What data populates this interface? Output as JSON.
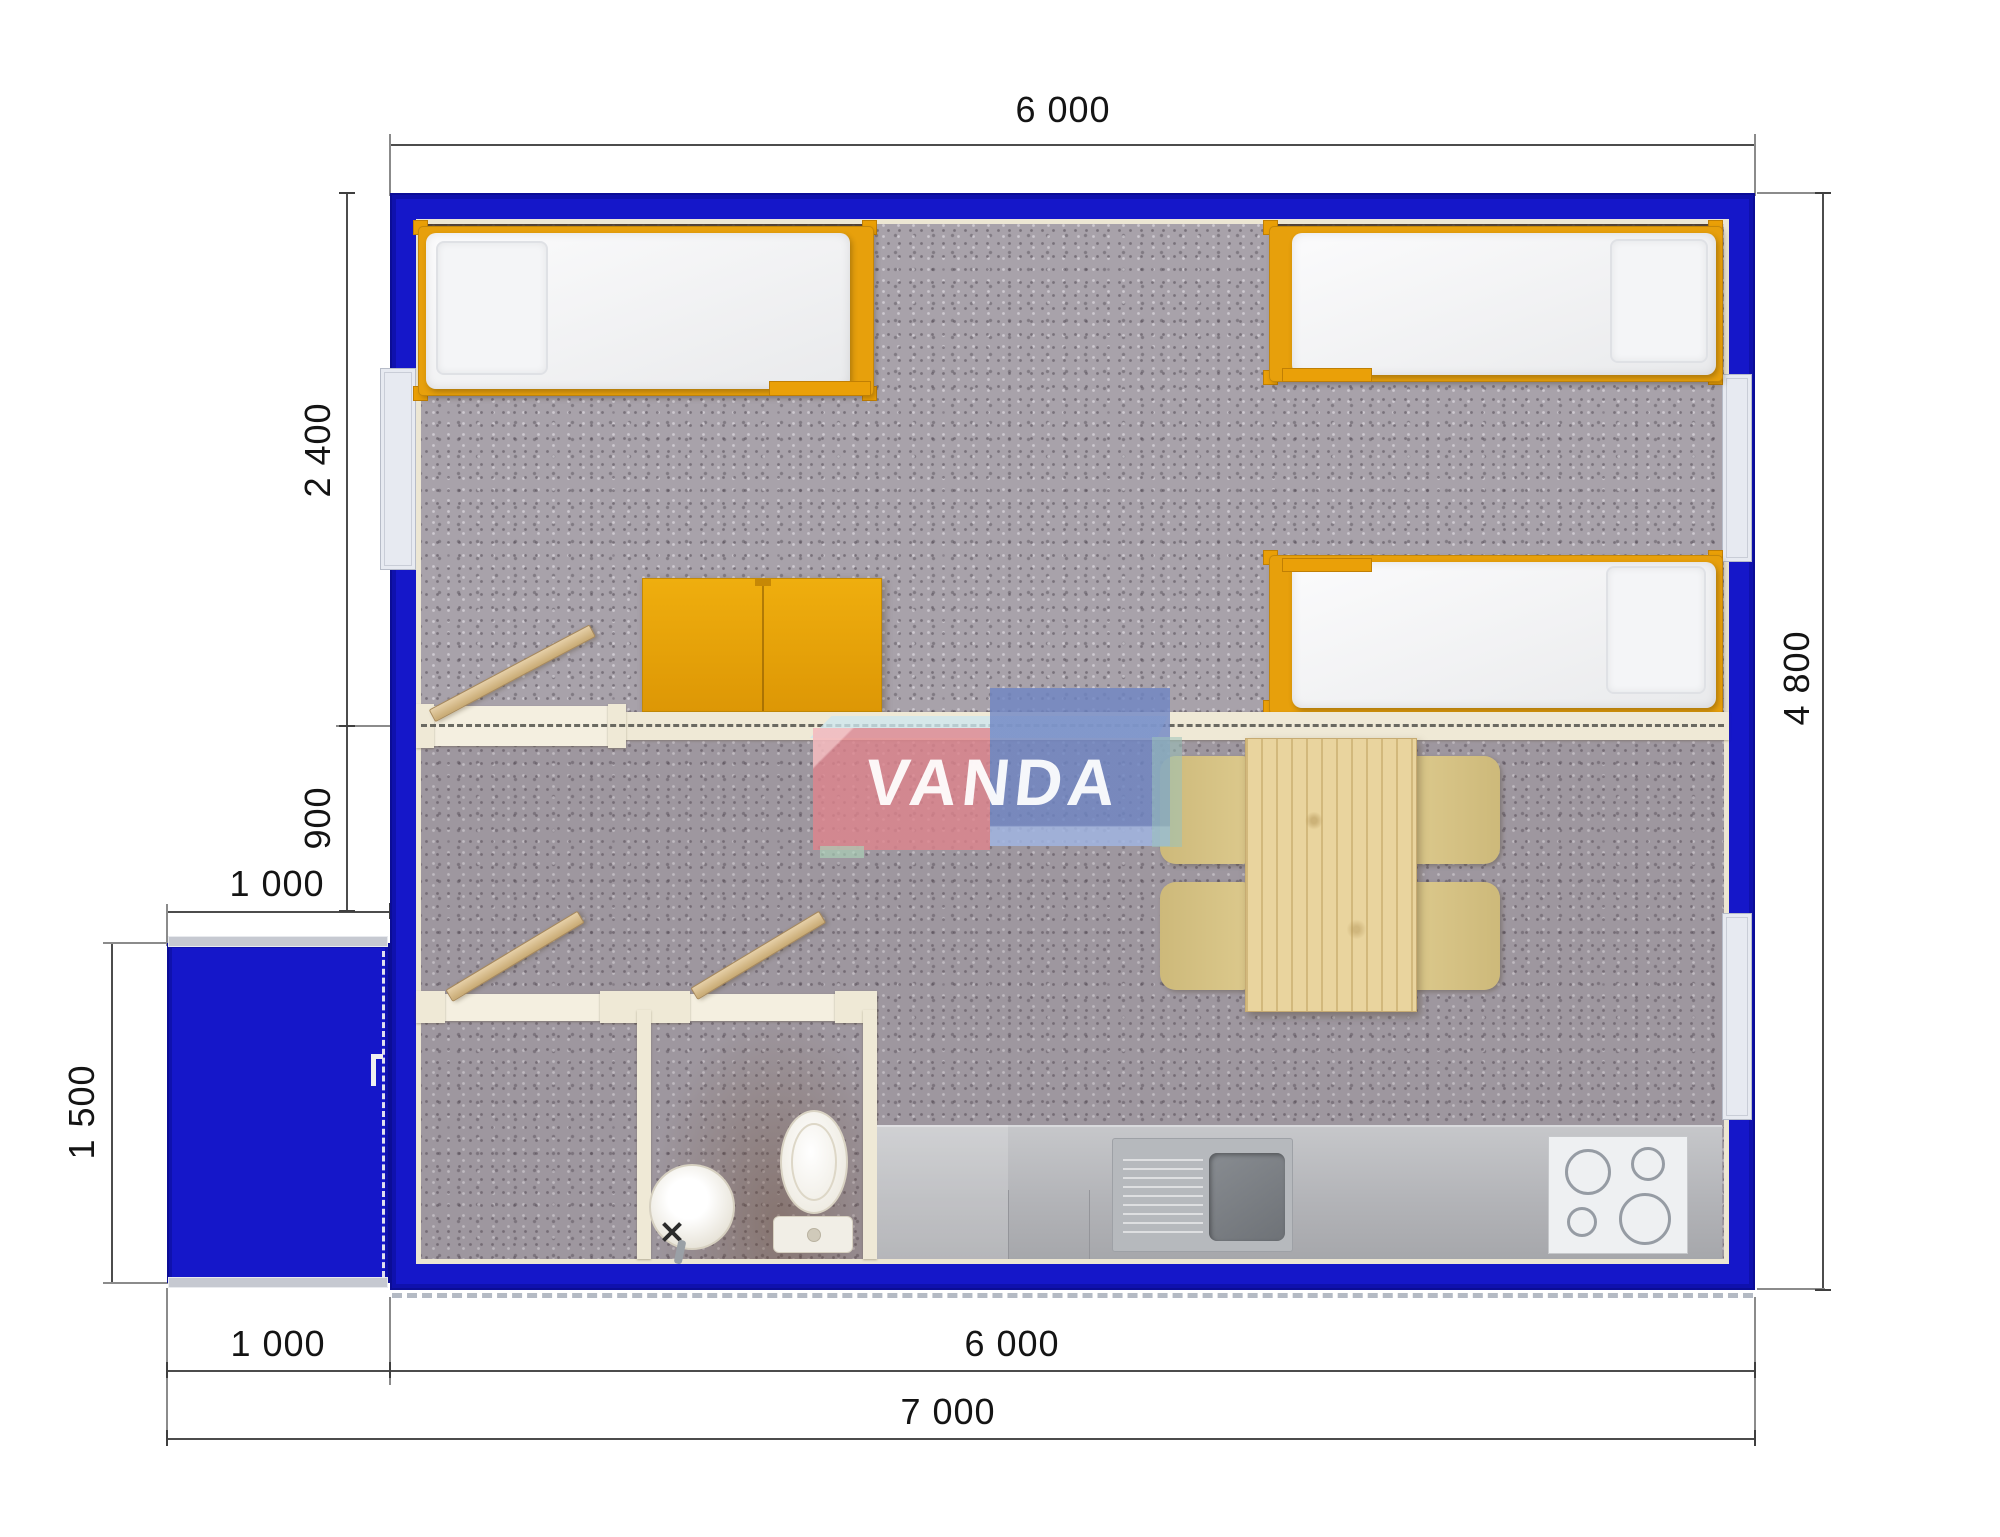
{
  "watermark": {
    "brand": "VANDA"
  },
  "dimensions": {
    "top_width": "6 000",
    "left_room_depth": "2 400",
    "left_mid_depth": "900",
    "porch_width_top": "1 000",
    "porch_depth": "1 500",
    "right_height": "4 800",
    "bottom_porch_width": "1 000",
    "bottom_main_width": "6 000",
    "bottom_total_width": "7 000"
  },
  "colors": {
    "wall_blue": "#1517c9",
    "furniture_orange": "#e7a00c",
    "door_wood": "#d5bc8e",
    "interior_cream": "#efe9d6",
    "carpet_grey": "#a8a2aa",
    "counter_grey": "#b5b6ba",
    "chair_tan": "#d5c284",
    "table_wood": "#e9d49e",
    "logo_pink": "#e0838c",
    "logo_blue": "#6e85c4",
    "logo_light_blue": "#cde7ee"
  }
}
